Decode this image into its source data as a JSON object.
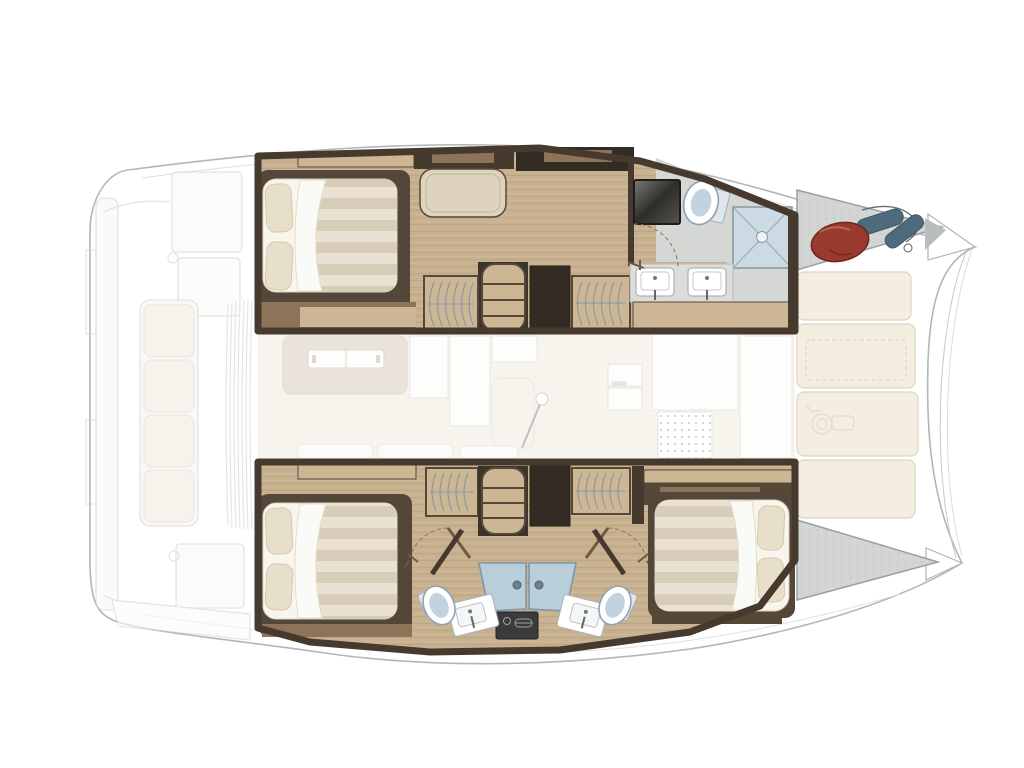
{
  "palette": {
    "background": "#ffffff",
    "hull_outline": "#b2b6b7",
    "deck_line": "#dfe0e0",
    "ghost_line": "#d3d3d1",
    "ghost_fill": "#f8f8f6",
    "ghost_cushion": "#f1ede2",
    "wall_dark": "#46392d",
    "wall_darker": "#332c24",
    "wood_mid": "#8d7459",
    "wood_light": "#cdb694",
    "bed_sheet": "#f7f5ec",
    "pillow": "#e8dfca",
    "seat_cushion": "#ded4bd",
    "counter_marble": "#dcdcda",
    "basin_white": "#ffffff",
    "shower_tray": "#ccdae4",
    "shower_line": "#93a6b2",
    "glass_door": "#b9cedb",
    "toilet_bowl": "#ffffff",
    "toilet_inner": "#c2d2de",
    "bath_gray_floor": "#d5d7d5",
    "deck_gray": "#d3d5d3",
    "deck_gray_edge": "#9aa0a0",
    "cushion_cream": "#f3eee0",
    "cushion_edge": "#ddd5bf",
    "buoy_red": "#993a2f",
    "buoy_red_dark": "#6f241c",
    "fender_blue": "#4e6b7d",
    "fender_blue_dark": "#3c5563",
    "vanity_dark": "#3b3b3b",
    "hanger_line": "#7f93a2",
    "door_arc": "#8a7157",
    "salon_floor": "#f3ede3",
    "salon_sofa": "#ddd3c6",
    "mirror_dark": "#2b2a28"
  }
}
